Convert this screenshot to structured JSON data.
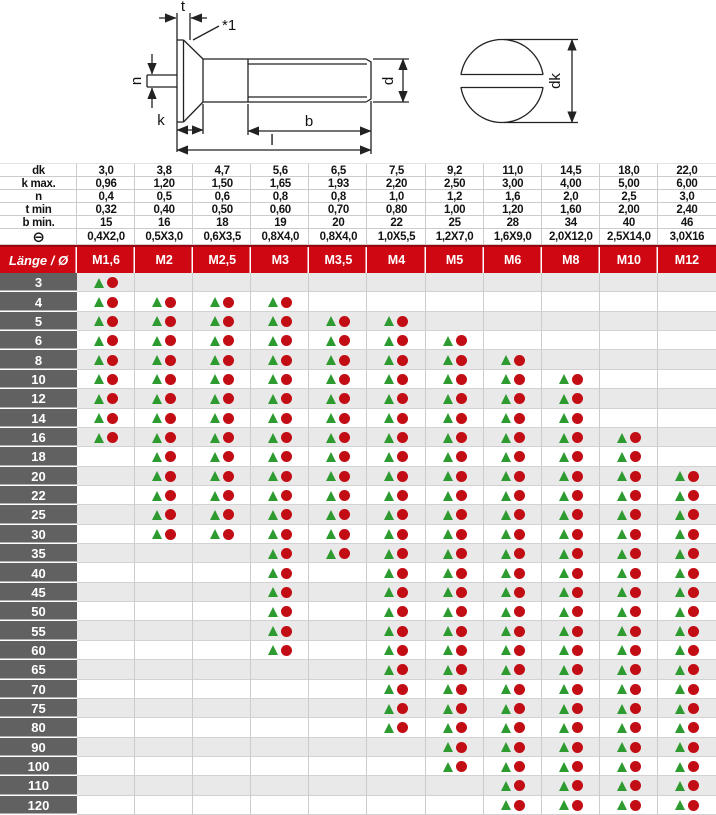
{
  "drawing": {
    "labels": {
      "t": "t",
      "ref_note": "*1",
      "n": "n",
      "k": "k",
      "b": "b",
      "l": "l",
      "d": "d",
      "dk": "dk"
    }
  },
  "table": {
    "spec_rows": [
      {
        "label": "dk",
        "symbol": false,
        "values": [
          "3,0",
          "3,8",
          "4,7",
          "5,6",
          "6,5",
          "7,5",
          "9,2",
          "11,0",
          "14,5",
          "18,0",
          "22,0"
        ]
      },
      {
        "label": "k max.",
        "symbol": false,
        "values": [
          "0,96",
          "1,20",
          "1,50",
          "1,65",
          "1,93",
          "2,20",
          "2,50",
          "3,00",
          "4,00",
          "5,00",
          "6,00"
        ]
      },
      {
        "label": "n",
        "symbol": false,
        "values": [
          "0,4",
          "0,5",
          "0,6",
          "0,8",
          "0,8",
          "1,0",
          "1,2",
          "1,6",
          "2,0",
          "2,5",
          "3,0"
        ]
      },
      {
        "label": "t min",
        "symbol": false,
        "values": [
          "0,32",
          "0,40",
          "0,50",
          "0,60",
          "0,70",
          "0,80",
          "1,00",
          "1,20",
          "1,60",
          "2,00",
          "2,40"
        ]
      },
      {
        "label": "b min.",
        "symbol": false,
        "values": [
          "15",
          "16",
          "18",
          "19",
          "20",
          "22",
          "25",
          "28",
          "34",
          "40",
          "46"
        ]
      },
      {
        "label": "⊖",
        "symbol": true,
        "values": [
          "0,4X2,0",
          "0,5X3,0",
          "0,6X3,5",
          "0,8X4,0",
          "0,8X4,0",
          "1,0X5,5",
          "1,2X7,0",
          "1,6X9,0",
          "2,0X12,0",
          "2,5X14,0",
          "3,0X16"
        ]
      }
    ],
    "header": {
      "label": "Länge / Ø",
      "columns": [
        "M1,6",
        "M2",
        "M2,5",
        "M3",
        "M3,5",
        "M4",
        "M5",
        "M6",
        "M8",
        "M10",
        "M12"
      ]
    },
    "rows": [
      {
        "length": "3",
        "available": [
          1,
          0,
          0,
          0,
          0,
          0,
          0,
          0,
          0,
          0,
          0
        ]
      },
      {
        "length": "4",
        "available": [
          1,
          1,
          1,
          1,
          0,
          0,
          0,
          0,
          0,
          0,
          0
        ]
      },
      {
        "length": "5",
        "available": [
          1,
          1,
          1,
          1,
          1,
          1,
          0,
          0,
          0,
          0,
          0
        ]
      },
      {
        "length": "6",
        "available": [
          1,
          1,
          1,
          1,
          1,
          1,
          1,
          0,
          0,
          0,
          0
        ]
      },
      {
        "length": "8",
        "available": [
          1,
          1,
          1,
          1,
          1,
          1,
          1,
          1,
          0,
          0,
          0
        ]
      },
      {
        "length": "10",
        "available": [
          1,
          1,
          1,
          1,
          1,
          1,
          1,
          1,
          1,
          0,
          0
        ]
      },
      {
        "length": "12",
        "available": [
          1,
          1,
          1,
          1,
          1,
          1,
          1,
          1,
          1,
          0,
          0
        ]
      },
      {
        "length": "14",
        "available": [
          1,
          1,
          1,
          1,
          1,
          1,
          1,
          1,
          1,
          0,
          0
        ]
      },
      {
        "length": "16",
        "available": [
          1,
          1,
          1,
          1,
          1,
          1,
          1,
          1,
          1,
          1,
          0
        ]
      },
      {
        "length": "18",
        "available": [
          0,
          1,
          1,
          1,
          1,
          1,
          1,
          1,
          1,
          1,
          0
        ]
      },
      {
        "length": "20",
        "available": [
          0,
          1,
          1,
          1,
          1,
          1,
          1,
          1,
          1,
          1,
          1
        ]
      },
      {
        "length": "22",
        "available": [
          0,
          1,
          1,
          1,
          1,
          1,
          1,
          1,
          1,
          1,
          1
        ]
      },
      {
        "length": "25",
        "available": [
          0,
          1,
          1,
          1,
          1,
          1,
          1,
          1,
          1,
          1,
          1
        ]
      },
      {
        "length": "30",
        "available": [
          0,
          1,
          1,
          1,
          1,
          1,
          1,
          1,
          1,
          1,
          1
        ]
      },
      {
        "length": "35",
        "available": [
          0,
          0,
          0,
          1,
          1,
          1,
          1,
          1,
          1,
          1,
          1
        ]
      },
      {
        "length": "40",
        "available": [
          0,
          0,
          0,
          1,
          0,
          1,
          1,
          1,
          1,
          1,
          1
        ]
      },
      {
        "length": "45",
        "available": [
          0,
          0,
          0,
          1,
          0,
          1,
          1,
          1,
          1,
          1,
          1
        ]
      },
      {
        "length": "50",
        "available": [
          0,
          0,
          0,
          1,
          0,
          1,
          1,
          1,
          1,
          1,
          1
        ]
      },
      {
        "length": "55",
        "available": [
          0,
          0,
          0,
          1,
          0,
          1,
          1,
          1,
          1,
          1,
          1
        ]
      },
      {
        "length": "60",
        "available": [
          0,
          0,
          0,
          1,
          0,
          1,
          1,
          1,
          1,
          1,
          1
        ]
      },
      {
        "length": "65",
        "available": [
          0,
          0,
          0,
          0,
          0,
          1,
          1,
          1,
          1,
          1,
          1
        ]
      },
      {
        "length": "70",
        "available": [
          0,
          0,
          0,
          0,
          0,
          1,
          1,
          1,
          1,
          1,
          1
        ]
      },
      {
        "length": "75",
        "available": [
          0,
          0,
          0,
          0,
          0,
          1,
          1,
          1,
          1,
          1,
          1
        ]
      },
      {
        "length": "80",
        "available": [
          0,
          0,
          0,
          0,
          0,
          1,
          1,
          1,
          1,
          1,
          1
        ]
      },
      {
        "length": "90",
        "available": [
          0,
          0,
          0,
          0,
          0,
          0,
          1,
          1,
          1,
          1,
          1
        ]
      },
      {
        "length": "100",
        "available": [
          0,
          0,
          0,
          0,
          0,
          0,
          1,
          1,
          1,
          1,
          1
        ]
      },
      {
        "length": "110",
        "available": [
          0,
          0,
          0,
          0,
          0,
          0,
          0,
          1,
          1,
          1,
          1
        ]
      },
      {
        "length": "120",
        "available": [
          0,
          0,
          0,
          0,
          0,
          0,
          0,
          1,
          1,
          1,
          1
        ]
      }
    ]
  },
  "colors": {
    "header_red": "#ce0712",
    "header_dark": "#9c0410",
    "label_gray": "#616161",
    "row_alt": "#e9e9e9",
    "grid": "#cccccc",
    "triangle_green": "#2d9b30",
    "circle_red": "#c30d15"
  }
}
